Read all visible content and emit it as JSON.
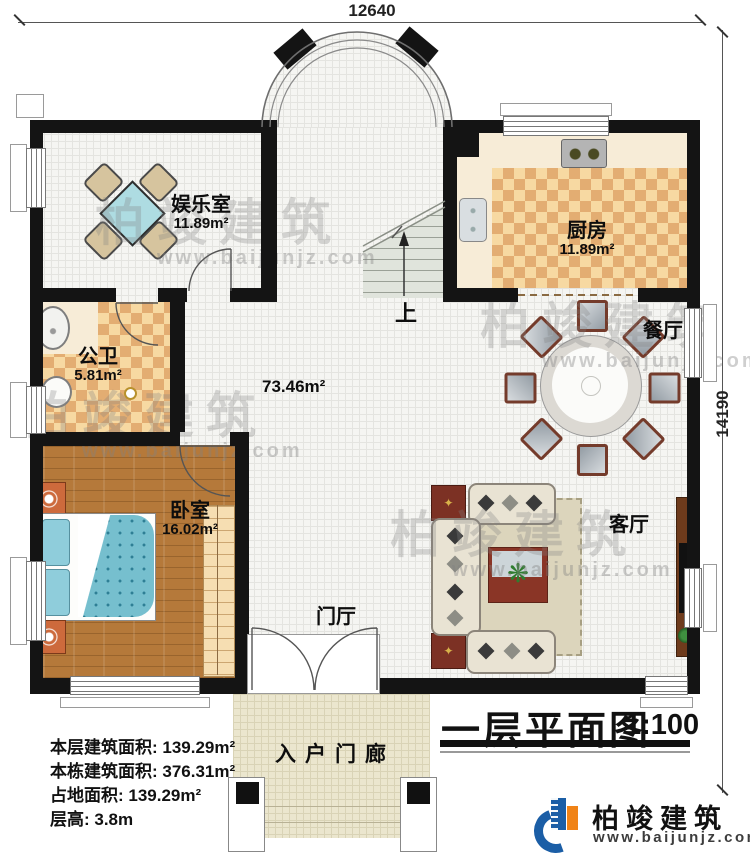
{
  "dimensions": {
    "top": "12640",
    "right": "14190"
  },
  "rooms": {
    "entertainment": {
      "name": "娱乐室",
      "area": "11.89m²"
    },
    "kitchen": {
      "name": "厨房",
      "area": "11.89m²"
    },
    "bathroom": {
      "name": "公卫",
      "area": "5.81m²"
    },
    "dining": {
      "name": "餐厅"
    },
    "bedroom": {
      "name": "卧室",
      "area": "16.02m²"
    },
    "living": {
      "name": "客厅"
    },
    "foyer": {
      "name": "门厅"
    },
    "porch": {
      "name": "入户门廊"
    },
    "hall": {
      "area": "73.46m²"
    },
    "stairs": {
      "direction": "上"
    }
  },
  "info": {
    "lines": [
      "本层建筑面积: 139.29m²",
      "本栋建筑面积: 376.31m²",
      "占地面积: 139.29m²",
      "层高: 3.8m"
    ]
  },
  "title_block": {
    "title": "一层平面图",
    "scale": "1:100"
  },
  "brand": {
    "name": "柏竣建筑",
    "site": "www.baijunjz.com"
  },
  "watermark": {
    "text": "柏竣建筑",
    "site": "www.baijunjz.com"
  },
  "colors": {
    "wall": "#141414",
    "checker_dark": "#e3ad72",
    "checker_light": "#f7d9a2",
    "wood": "#b5793a",
    "bed_blue": "#76bfce",
    "logo_blue": "#1b5ea6",
    "logo_orange": "#f08317"
  }
}
